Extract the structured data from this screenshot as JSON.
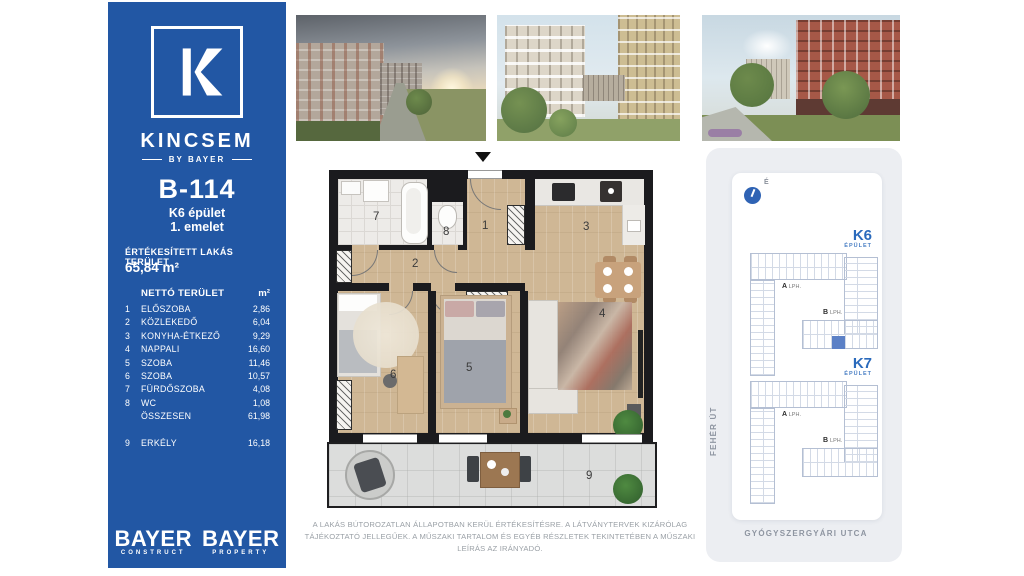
{
  "sidebar": {
    "brand": {
      "name": "KINCSEM",
      "tagline": "BY BAYER"
    },
    "unit_id": "B-114",
    "building": "K6 épület",
    "floor": "1. emelet",
    "sold_area_label": "ÉRTÉKESÍTETT LAKÁS TERÜLET",
    "sold_area_value": "65,84 m²",
    "table": {
      "header_name": "NETTÓ TERÜLET",
      "header_unit": "m²",
      "rows": [
        {
          "num": "1",
          "name": "ELŐSZOBA",
          "value": "2,86"
        },
        {
          "num": "2",
          "name": "KÖZLEKEDŐ",
          "value": "6,04"
        },
        {
          "num": "3",
          "name": "KONYHA-ÉTKEZŐ",
          "value": "9,29"
        },
        {
          "num": "4",
          "name": "NAPPALI",
          "value": "16,60"
        },
        {
          "num": "5",
          "name": "SZOBA",
          "value": "11,46"
        },
        {
          "num": "6",
          "name": "SZOBA",
          "value": "10,57"
        },
        {
          "num": "7",
          "name": "FÜRDŐSZOBA",
          "value": "4,08"
        },
        {
          "num": "8",
          "name": "WC",
          "value": "1,08"
        }
      ],
      "total": {
        "name": "ÖSSZESEN",
        "value": "61,98"
      },
      "extra": {
        "num": "9",
        "name": "ERKÉLY",
        "value": "16,18"
      }
    },
    "logos": [
      {
        "word": "BAYER",
        "sub": "CONSTRUCT"
      },
      {
        "word": "BAYER",
        "sub": "PROPERTY"
      }
    ]
  },
  "floorplan": {
    "rooms": {
      "r1": "1",
      "r2": "2",
      "r3": "3",
      "r4": "4",
      "r5": "5",
      "r6": "6",
      "r7": "7",
      "r8": "8",
      "r9": "9"
    }
  },
  "site_map": {
    "north_label": "É",
    "street_left": "FEHÉR ÚT",
    "street_bottom": "GYÓGYSZERGYÁRI UTCA",
    "buildings": [
      {
        "id": "K6",
        "type_label": "ÉPÜLET",
        "stair_a": "A",
        "stair_a_sub": "LPH.",
        "stair_b": "B",
        "stair_b_sub": "LPH."
      },
      {
        "id": "K7",
        "type_label": "ÉPÜLET",
        "stair_a": "A",
        "stair_a_sub": "LPH.",
        "stair_b": "B",
        "stair_b_sub": "LPH."
      }
    ]
  },
  "disclaimer": "A LAKÁS BÚTOROZATLAN ÁLLAPOTBAN KERÜL ÉRTÉKESÍTÉSRE. A LÁTVÁNYTERVEK KIZÁRÓLAG TÁJÉKOZTATÓ JELLEGŰEK. A MŰSZAKI TARTALOM ÉS EGYÉB RÉSZLETEK TEKINTETÉBEN A MŰSZAKI LEÍRÁS AZ IRÁNYADÓ.",
  "colors": {
    "sidebar_blue": "#2257a4",
    "accent_blue": "#2a6abc",
    "highlight_unit": "#5b80c6"
  }
}
